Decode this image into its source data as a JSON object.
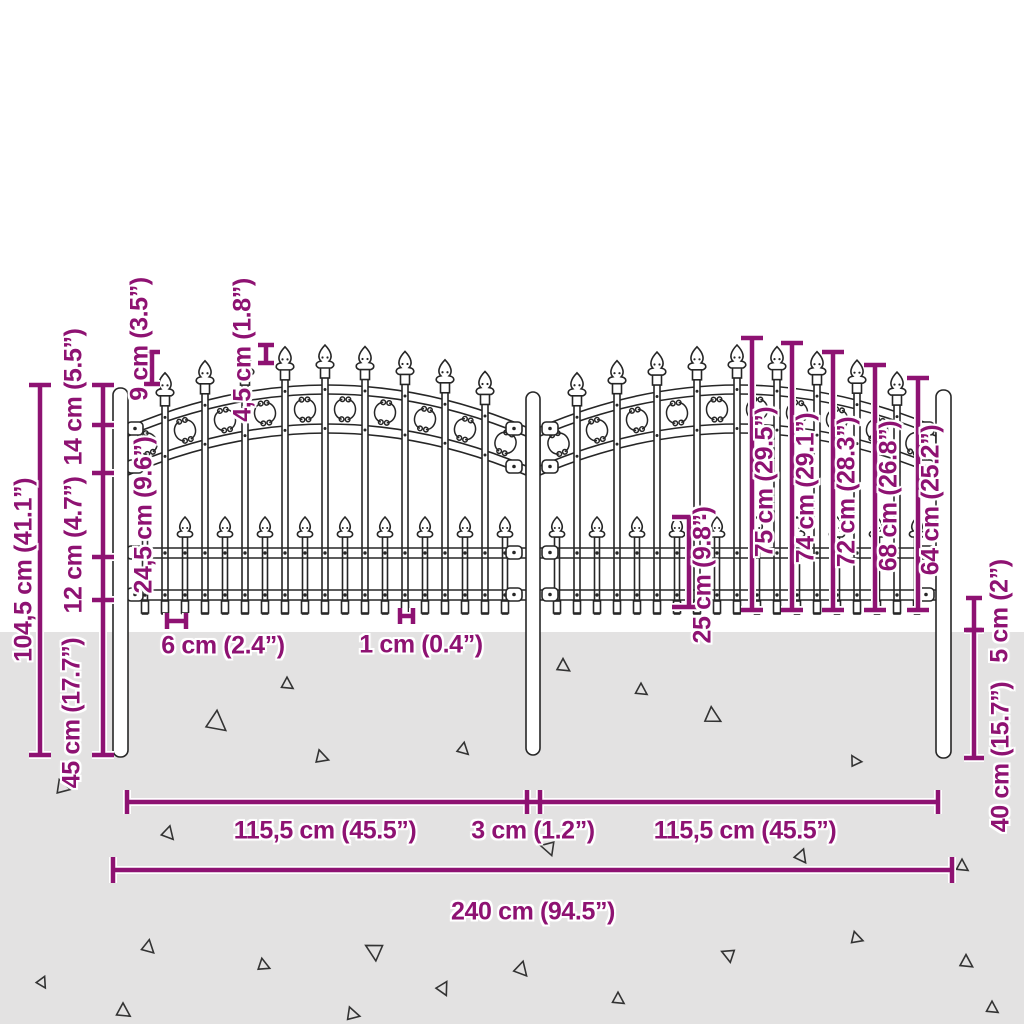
{
  "diagram": {
    "kind": "product-dimension-diagram",
    "subject": "garden fence with spear-top pickets and arched scroll panels"
  },
  "colors": {
    "dimension": "#8e1272",
    "fence": "#262626",
    "ground": "#e3e2e2",
    "triangle": "#333333",
    "background": "#ffffff"
  },
  "labels": {
    "total_height": "104,5 cm (41.1”)",
    "embed_left": "45 cm (17.7”)",
    "rail_spacing": "12 cm (4.7”)",
    "top_offset": "14 cm (5.5”)",
    "spike_height": "9 cm (3.5”)",
    "mid_section_height": "24,5 cm (9.6”)",
    "tip_step": "4,5 cm (1.8”)",
    "picket_gap": "6 cm (2.4”)",
    "picket_width": "1 cm (0.4”)",
    "short_picket_height": "25 cm (9.8”)",
    "picket_75": "75 cm (29.5”)",
    "picket_74": "74 cm (29.1”)",
    "picket_72": "72 cm (28.3”)",
    "picket_68": "68 cm (26.8”)",
    "picket_64": "64 cm (25.2”)",
    "ground_clearance": "5 cm (2”)",
    "embed_right": "40 cm (15.7”)",
    "panel_width_left": "115,5 cm (45.5”)",
    "post_gap": "3 cm (1.2”)",
    "panel_width_right": "115,5 cm (45.5”)",
    "total_width": "240 cm (94.5”)"
  }
}
